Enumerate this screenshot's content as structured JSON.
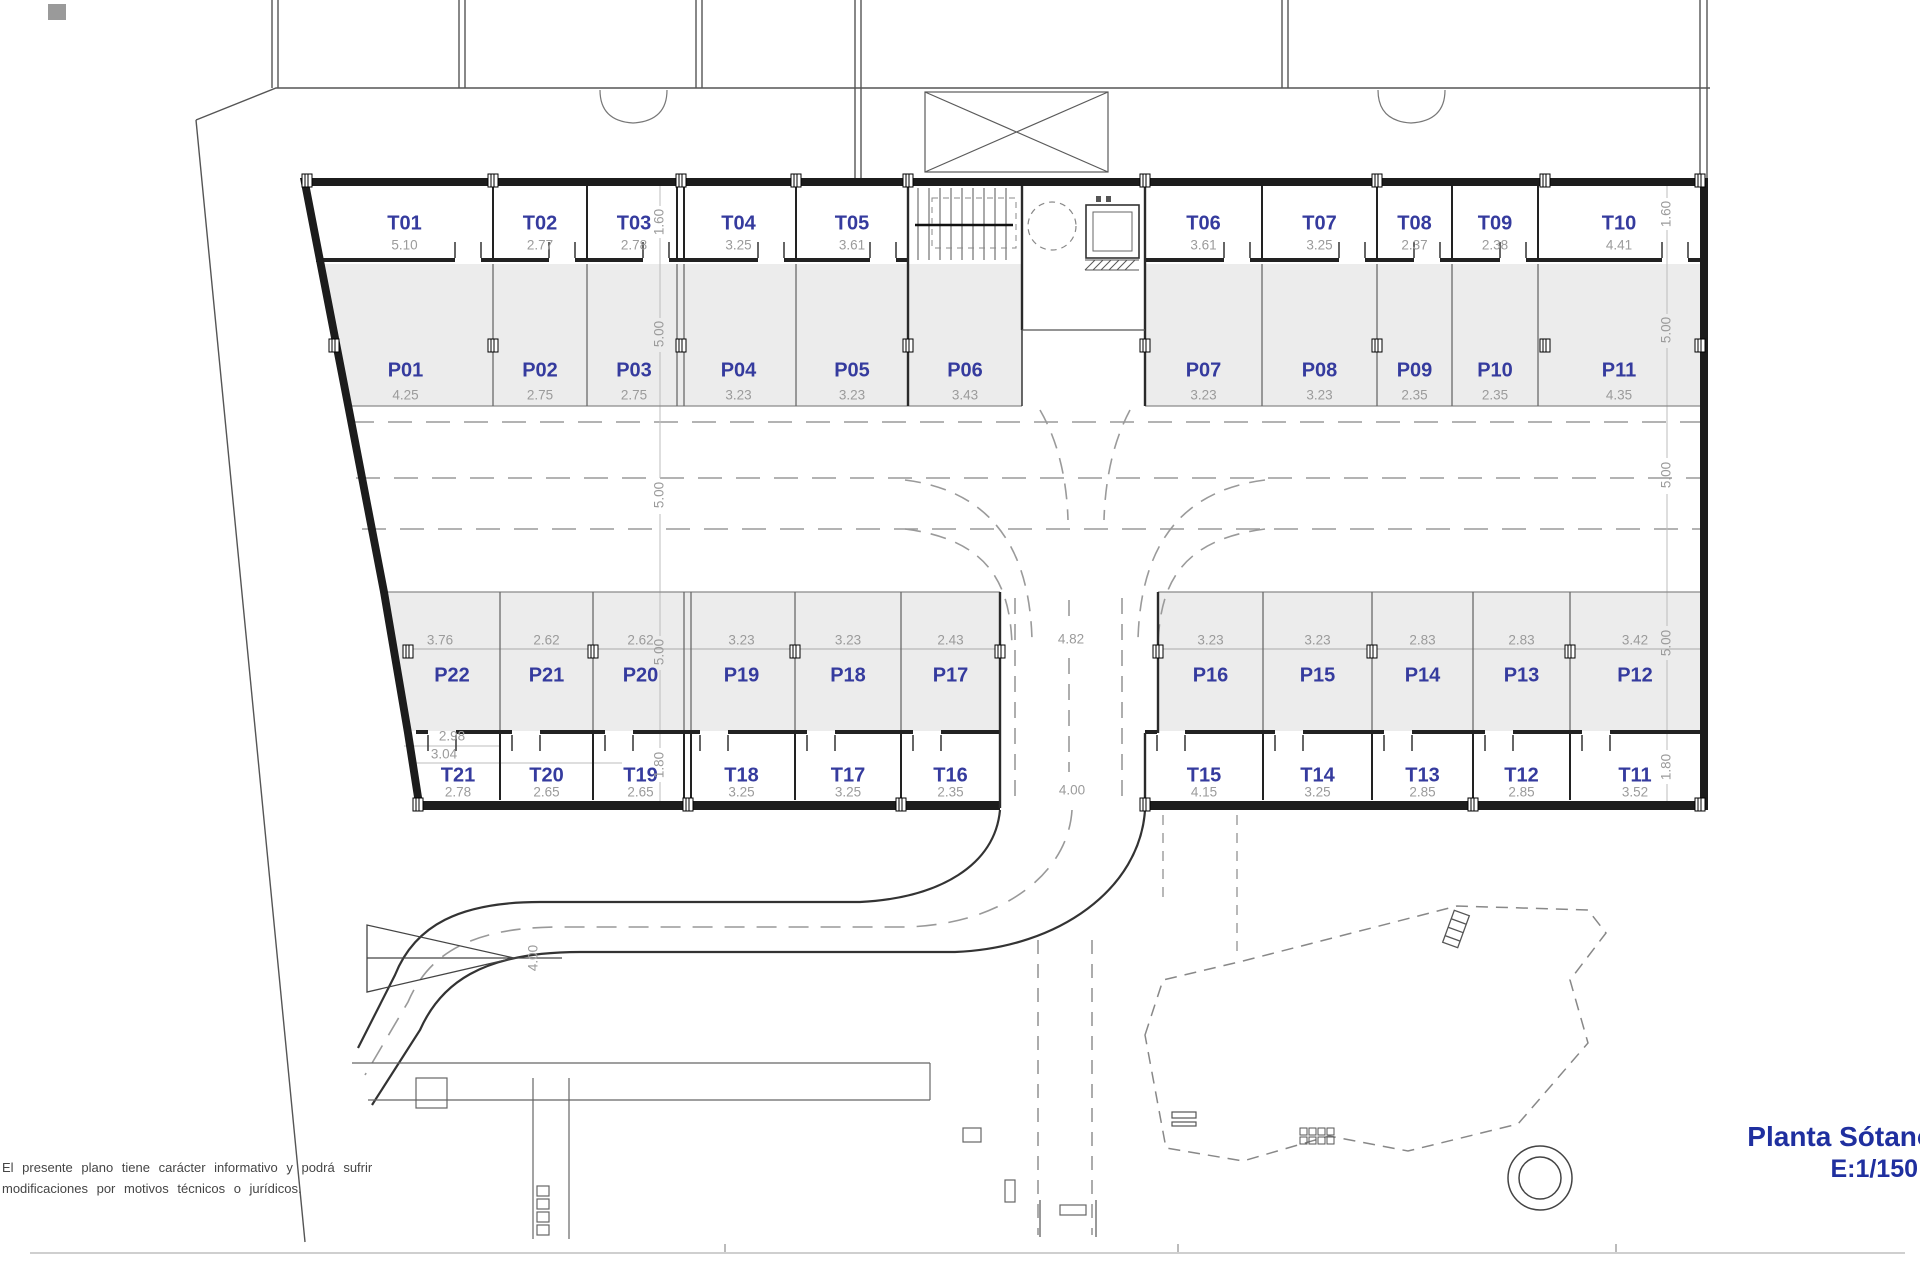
{
  "title_block": {
    "title": "Planta Sótano",
    "scale": "E:1/150"
  },
  "disclaimer": {
    "line1": "El presente plano tiene carácter informativo y podrá sufrir",
    "line2": "modificaciones por motivos técnicos o jurídicos."
  },
  "colors": {
    "label_blue": "#353b9e",
    "title_blue": "#1f2f9f",
    "dim_gray": "#9b9b9b",
    "stall_fill": "#ececec",
    "wall": "#1c1c1c"
  },
  "plan": {
    "rows": {
      "top_t": {
        "y1": 186,
        "y2": 258,
        "label_y": 224,
        "dim_y": 246
      },
      "top_p": {
        "y1": 264,
        "y2": 406,
        "label_y": 371,
        "dim_y": 396
      },
      "bottom_p": {
        "y1": 592,
        "y2": 731,
        "label_y": 676,
        "dim_y": 641
      },
      "bottom_t": {
        "y1": 733,
        "y2": 800,
        "label_y": 776,
        "dim_y": 793
      }
    },
    "top_t": [
      {
        "id": "T01",
        "dim": "5.10",
        "x1": 316,
        "x2": 493
      },
      {
        "id": "T02",
        "dim": "2.77",
        "x1": 493,
        "x2": 587
      },
      {
        "id": "T03",
        "dim": "2.78",
        "x1": 587,
        "x2": 681,
        "dbl": true
      },
      {
        "id": "T04",
        "dim": "3.25",
        "x1": 681,
        "x2": 796
      },
      {
        "id": "T05",
        "dim": "3.61",
        "x1": 796,
        "x2": 908
      },
      {
        "id": "T06",
        "dim": "3.61",
        "x1": 1145,
        "x2": 1262
      },
      {
        "id": "T07",
        "dim": "3.25",
        "x1": 1262,
        "x2": 1377
      },
      {
        "id": "T08",
        "dim": "2.37",
        "x1": 1377,
        "x2": 1452
      },
      {
        "id": "T09",
        "dim": "2.38",
        "x1": 1452,
        "x2": 1538
      },
      {
        "id": "T10",
        "dim": "4.41",
        "x1": 1538,
        "x2": 1700
      }
    ],
    "top_p": [
      {
        "id": "P01",
        "dim": "4.25",
        "x1": 318,
        "x2": 493,
        "x1b": 345
      },
      {
        "id": "P02",
        "dim": "2.75",
        "x1": 493,
        "x2": 587
      },
      {
        "id": "P03",
        "dim": "2.75",
        "x1": 587,
        "x2": 681,
        "dbl": true
      },
      {
        "id": "P04",
        "dim": "3.23",
        "x1": 681,
        "x2": 796
      },
      {
        "id": "P05",
        "dim": "3.23",
        "x1": 796,
        "x2": 908
      },
      {
        "id": "P06",
        "dim": "3.43",
        "x1": 908,
        "x2": 1022
      },
      {
        "id": "P07",
        "dim": "3.23",
        "x1": 1145,
        "x2": 1262
      },
      {
        "id": "P08",
        "dim": "3.23",
        "x1": 1262,
        "x2": 1377
      },
      {
        "id": "P09",
        "dim": "2.35",
        "x1": 1377,
        "x2": 1452
      },
      {
        "id": "P10",
        "dim": "2.35",
        "x1": 1452,
        "x2": 1538
      },
      {
        "id": "P11",
        "dim": "4.35",
        "x1": 1538,
        "x2": 1700
      }
    ],
    "bottom_p": [
      {
        "id": "P22",
        "dim": "3.76",
        "x1": 380,
        "x2": 500,
        "x1b": 404,
        "cxl": 452,
        "cxd": 440
      },
      {
        "id": "P21",
        "dim": "2.62",
        "x1": 500,
        "x2": 593
      },
      {
        "id": "P20",
        "dim": "2.62",
        "x1": 593,
        "x2": 688,
        "dbl": true
      },
      {
        "id": "P19",
        "dim": "3.23",
        "x1": 688,
        "x2": 795
      },
      {
        "id": "P18",
        "dim": "3.23",
        "x1": 795,
        "x2": 901
      },
      {
        "id": "P17",
        "dim": "2.43",
        "x1": 901,
        "x2": 1000
      },
      {
        "id": "P16",
        "dim": "3.23",
        "x1": 1158,
        "x2": 1263
      },
      {
        "id": "P15",
        "dim": "3.23",
        "x1": 1263,
        "x2": 1372
      },
      {
        "id": "P14",
        "dim": "2.83",
        "x1": 1372,
        "x2": 1473
      },
      {
        "id": "P13",
        "dim": "2.83",
        "x1": 1473,
        "x2": 1570
      },
      {
        "id": "P12",
        "dim": "3.42",
        "x1": 1570,
        "x2": 1700
      }
    ],
    "bottom_t": [
      {
        "id": "T21",
        "dim": "2.78",
        "x1": 416,
        "x2": 500
      },
      {
        "id": "T20",
        "dim": "2.65",
        "x1": 500,
        "x2": 593
      },
      {
        "id": "T19",
        "dim": "2.65",
        "x1": 593,
        "x2": 688,
        "dbl": true
      },
      {
        "id": "T18",
        "dim": "3.25",
        "x1": 688,
        "x2": 795
      },
      {
        "id": "T17",
        "dim": "3.25",
        "x1": 795,
        "x2": 901
      },
      {
        "id": "T16",
        "dim": "2.35",
        "x1": 901,
        "x2": 1000
      },
      {
        "id": "T15",
        "dim": "4.15",
        "x1": 1145,
        "x2": 1263
      },
      {
        "id": "T14",
        "dim": "3.25",
        "x1": 1263,
        "x2": 1372
      },
      {
        "id": "T13",
        "dim": "2.85",
        "x1": 1372,
        "x2": 1473
      },
      {
        "id": "T12",
        "dim": "2.85",
        "x1": 1473,
        "x2": 1570
      },
      {
        "id": "T11",
        "dim": "3.52",
        "x1": 1570,
        "x2": 1700
      }
    ],
    "side_dims_left": [
      {
        "text": "1.60",
        "x": 660,
        "y": 222
      },
      {
        "text": "5.00",
        "x": 660,
        "y": 334
      },
      {
        "text": "5.00",
        "x": 660,
        "y": 495
      },
      {
        "text": "5.00",
        "x": 660,
        "y": 652
      },
      {
        "text": "1.80",
        "x": 660,
        "y": 765
      }
    ],
    "side_dims_right": [
      {
        "text": "1.60",
        "x": 1667,
        "y": 214
      },
      {
        "text": "5.00",
        "x": 1667,
        "y": 330
      },
      {
        "text": "5.00",
        "x": 1667,
        "y": 475
      },
      {
        "text": "5.00",
        "x": 1667,
        "y": 643
      },
      {
        "text": "1.80",
        "x": 1667,
        "y": 767
      }
    ],
    "extra_dims": [
      {
        "text": "4.82",
        "x": 1071,
        "y": 640,
        "rot": false
      },
      {
        "text": "4.00",
        "x": 1072,
        "y": 791,
        "rot": false
      },
      {
        "text": "4.00",
        "x": 534,
        "y": 958,
        "rot": true
      },
      {
        "text": "2.98",
        "x": 452,
        "y": 737,
        "rot": false
      },
      {
        "text": "3.04",
        "x": 444,
        "y": 755,
        "rot": false
      }
    ]
  }
}
